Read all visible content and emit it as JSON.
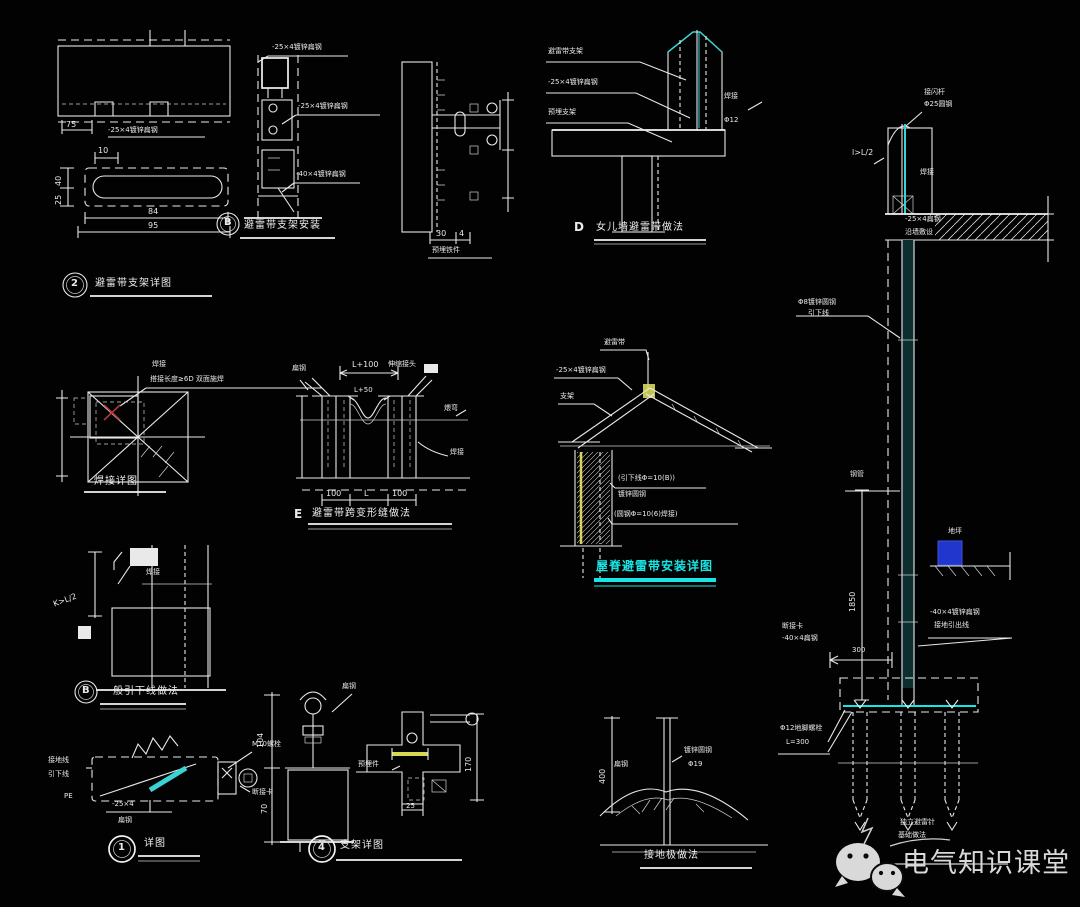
{
  "colors": {
    "background": "#020202",
    "line": "#e9e9e9",
    "cyan": "#3ad2d2",
    "bright_cyan": "#18e6e6",
    "yellow": "#d8d855",
    "blue": "#2136cc",
    "red": "#b23636",
    "watermark_gray": "#d9d9d9"
  },
  "details": {
    "slab_bracket": {
      "badge": "2",
      "title": "避雷带支架详图",
      "note": "-25×4镀锌扁钢",
      "dim_side": "75",
      "plate": {
        "dim_top": "10",
        "dim_left_a": "40",
        "dim_left_b": "25",
        "dim_b1": "84",
        "dim_b2": "95"
      }
    },
    "stem_bracket": {
      "badge": "B",
      "title": "避雷带支架安装",
      "labels": [
        "-25×4镀锌扁钢",
        "-25×4镀锌扁钢",
        "-40×4镀锌扁钢"
      ]
    },
    "wall_embed": {
      "title": "预埋铁件",
      "dim_a": "30",
      "dim_b": "4"
    },
    "parapet": {
      "badge": "D",
      "title": "女儿墙避雷带做法",
      "labels": [
        "避雷带支架",
        "-25×4镀锌扁钢",
        "预埋支架"
      ],
      "note_a": "焊接",
      "note_b": "Φ12"
    },
    "weld": {
      "title": "焊接详图",
      "note_small": "焊接",
      "label": "搭接长度≥6D 双面施焊"
    },
    "joint": {
      "badge": "E",
      "title": "避雷带跨变形缝做法",
      "dim_top": "L+100",
      "dim_mid": "L+50",
      "dims_bottom": [
        "100",
        "L",
        "100"
      ],
      "label_tl": "扁钢",
      "label_tr": "伸缩接头",
      "label_r": "煨弯",
      "label_br": "焊接"
    },
    "ridge": {
      "title": "屋脊避雷带安装详图",
      "labels": [
        "避雷带",
        "-25×4镀锌扁钢",
        "支架"
      ],
      "note_a": "(引下线Φ=10(B))",
      "note_a2": "镀锌圆钢",
      "note_b": "(圆钢Φ=10(6)焊接)"
    },
    "downlead": {
      "badge": "B",
      "title": "一般引下线做法",
      "dim": "K>L/2",
      "note": "焊接"
    },
    "clamp_box": {
      "badge": "1",
      "title": "详图",
      "label_left1": "接地线",
      "label_left2": "引下线",
      "label_top": "M10螺栓",
      "label_right": "断接卡",
      "note_pe": "PE",
      "note_b1": "-25×4",
      "note_b2": "扁钢"
    },
    "bracket4": {
      "badge": "4",
      "title": "支架详图",
      "dim_h1": "104",
      "dim_h2": "70",
      "dim_r": "170",
      "dim_b": "25",
      "label_top": "扁钢",
      "label_mid": "预埋件"
    },
    "rod_ground": {
      "title": "接地极做法",
      "dim": "400",
      "label_l": "扁钢",
      "label_r1": "镀锌圆钢",
      "label_r2": "Φ19"
    },
    "mast": {
      "label_top1": "接闪杆",
      "label_top2": "Φ25圆钢",
      "label_l2": "l>L/2",
      "note_weld": "焊接",
      "band_t1": "-25×4扁钢",
      "band_t2": "沿墙敷设",
      "label_mid1": "Φ8镀锌圆钢",
      "label_mid2": "引下线",
      "label_pipe": "钢管",
      "dim_v": "1850",
      "note_ground": "地坪",
      "label_r1": "-40×4镀锌扁钢",
      "label_r2": "接地引出线",
      "label_l3a": "断接卡",
      "label_l3b": "-40×4扁钢",
      "dim_300": "300",
      "label_bolt1": "Φ12地脚螺栓",
      "label_bolt2": "L=300",
      "cap1": "独立避雷针",
      "cap2": "基础做法"
    }
  },
  "watermark": {
    "name": "电气知识课堂"
  }
}
